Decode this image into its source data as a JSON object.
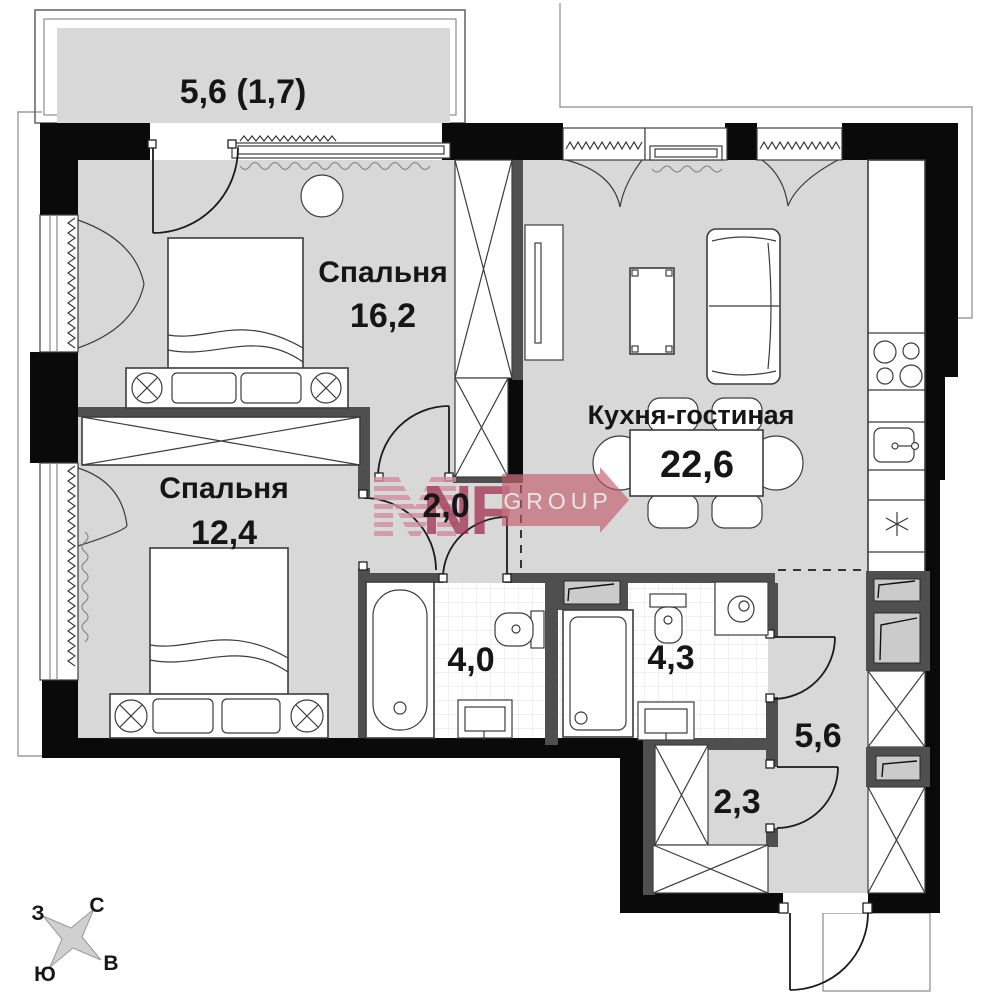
{
  "rooms": {
    "balcony": {
      "label": "5,6 (1,7)"
    },
    "bedroom_1": {
      "name": "Спальня",
      "area": "16,2"
    },
    "bedroom_2": {
      "name": "Спальня",
      "area": "12,4"
    },
    "kitchen_living": {
      "name": "Кухня-гостиная",
      "area": "22,6"
    },
    "hallway": {
      "area": "2,0"
    },
    "bathroom_1": {
      "area": "4,0"
    },
    "bathroom_2": {
      "area": "4,3"
    },
    "corridor": {
      "area": "5,6"
    },
    "wardrobe_room": {
      "area": "2,3"
    }
  },
  "compass": {
    "north": "С",
    "east": "В",
    "south": "Ю",
    "west": "З"
  },
  "watermark": {
    "brand": "NF",
    "suffix": "GROUP"
  },
  "palette": {
    "floor_gray": "#D8D8D8",
    "wall_black": "#0A0A0A",
    "accent_red": "#9B2242",
    "banner_red": "#C05767"
  }
}
